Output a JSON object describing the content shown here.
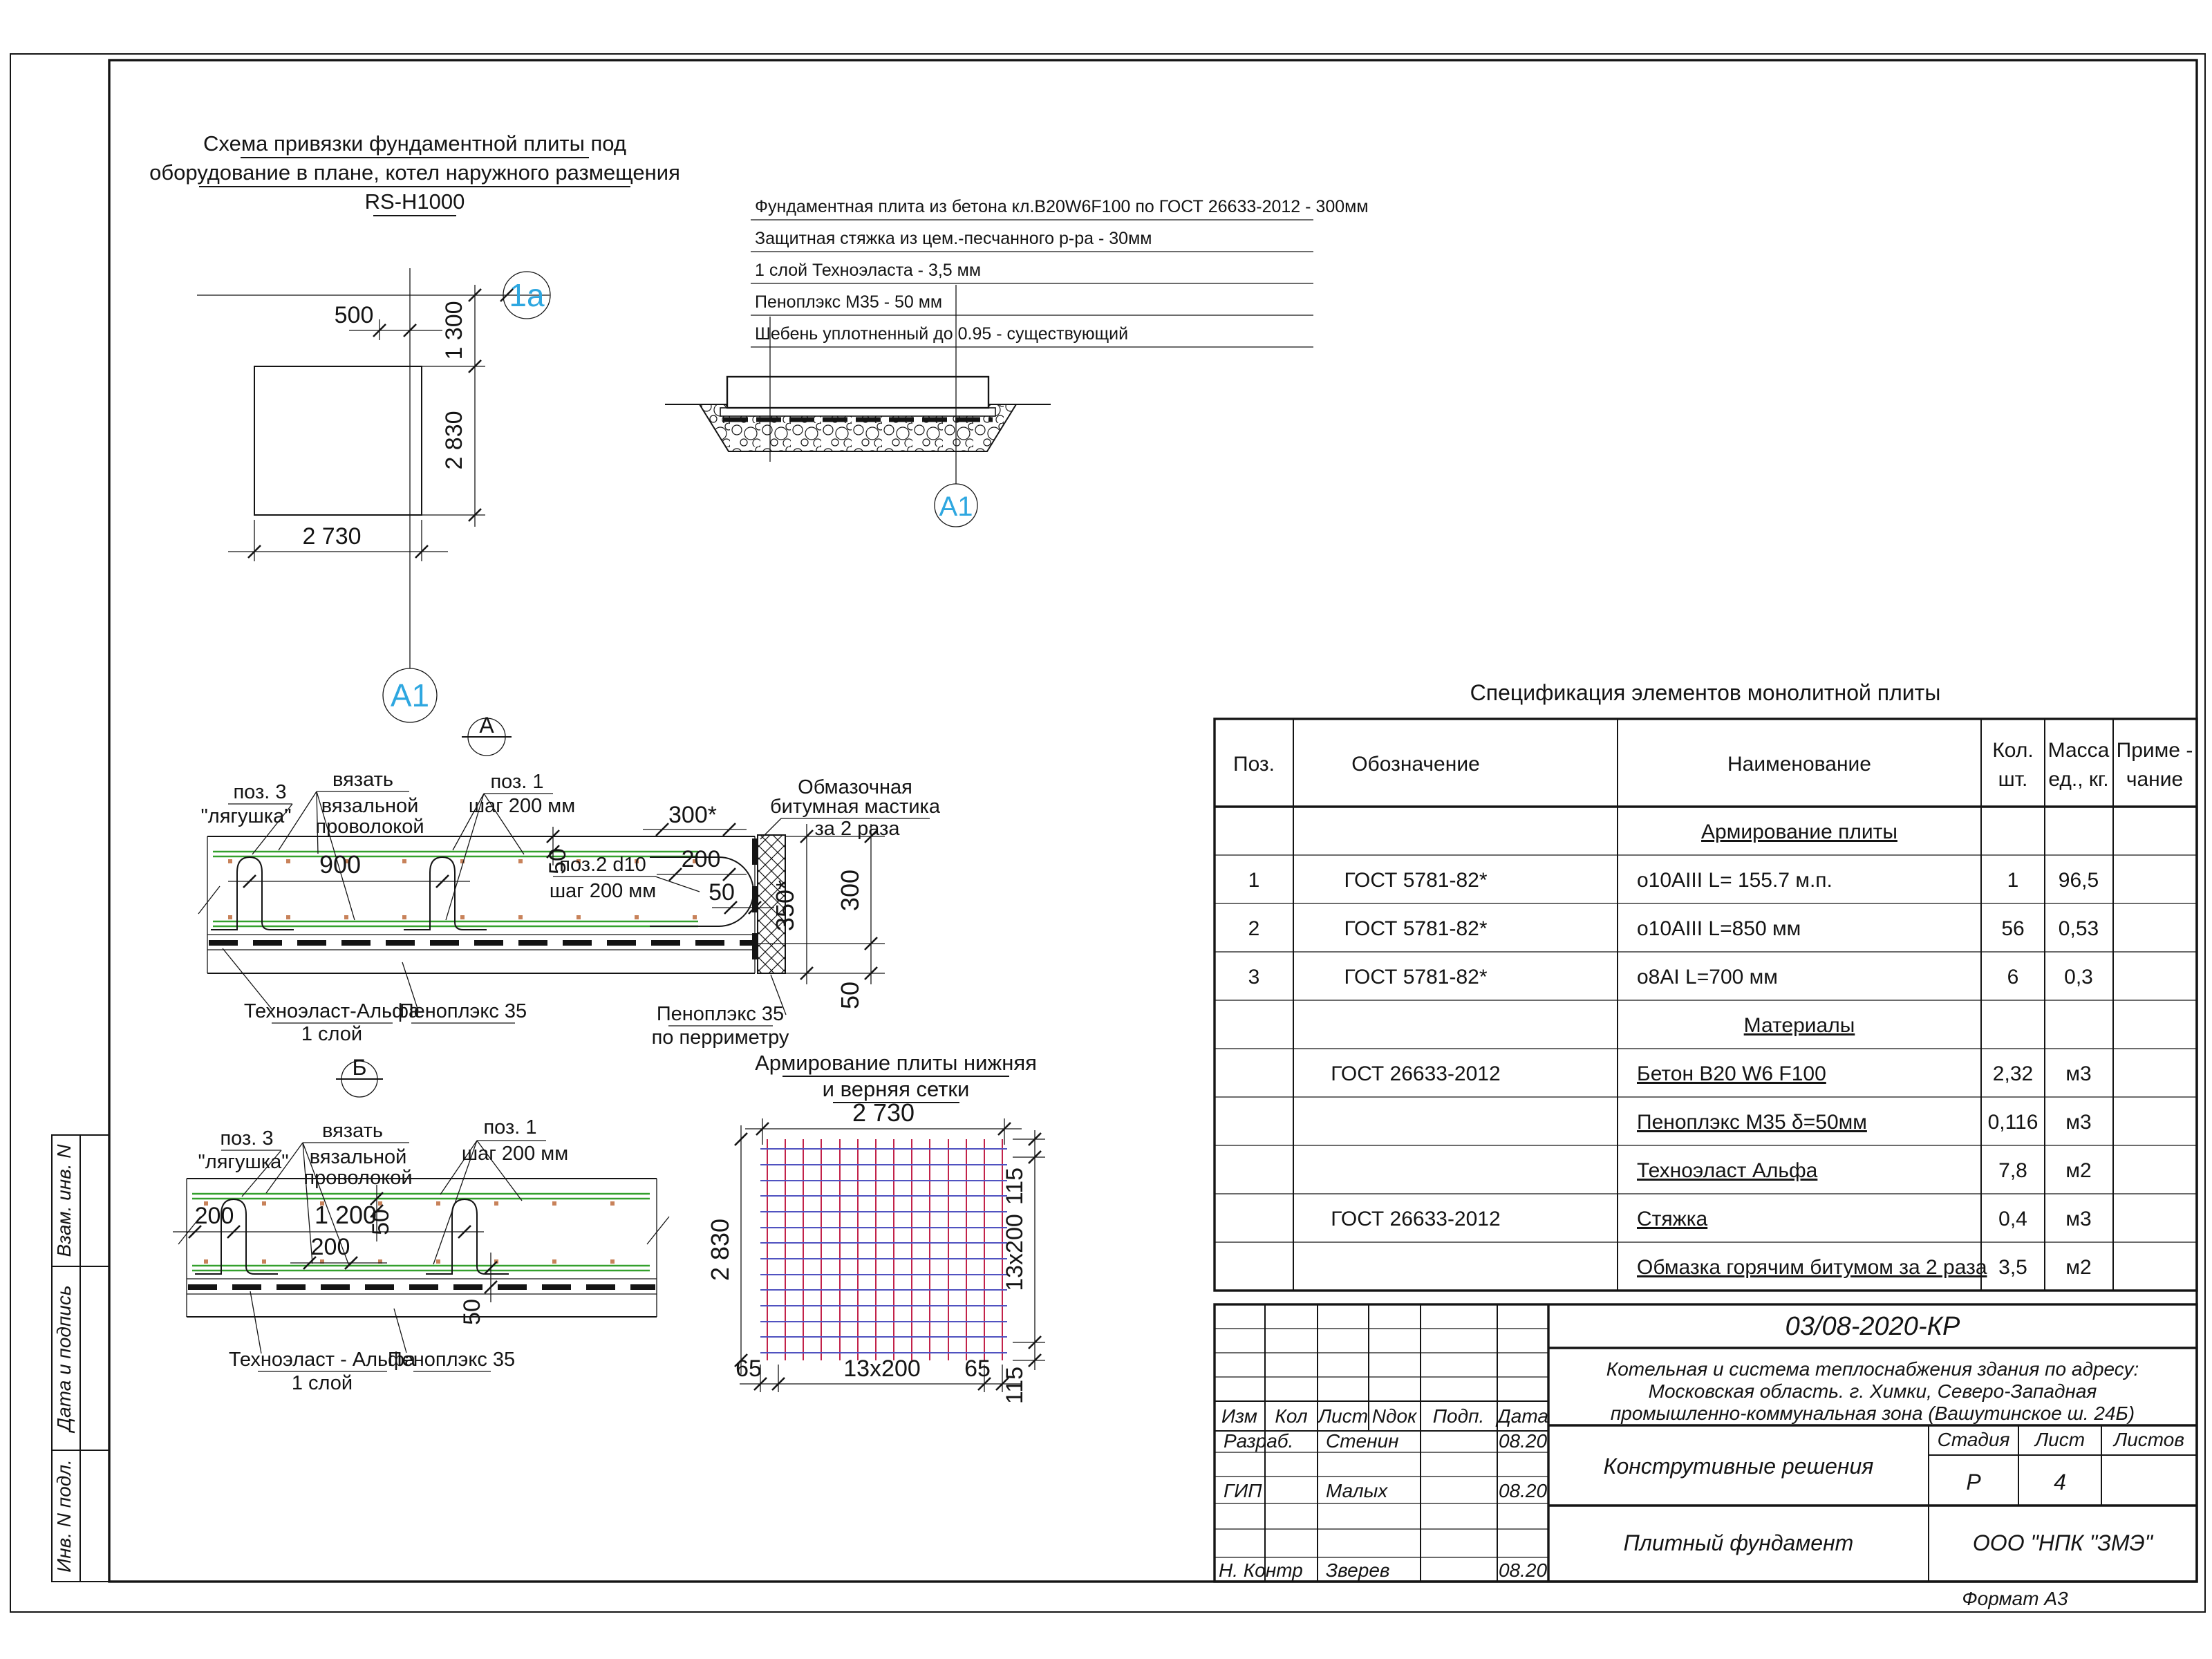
{
  "sheet": {
    "format_label": "Формат А3",
    "side_labels": [
      "Взам. инв. N",
      "Дата и подпись",
      "Инв. N подл."
    ]
  },
  "colors": {
    "axis_marker_blue": "#2ea7e0",
    "mesh_green": "#33a02c",
    "grid_red": "#c2224a",
    "grid_blue": "#5052c0",
    "dot_orange": "#c8825a"
  },
  "plan": {
    "title_line1": "Схема привязки фундаментной плиты под",
    "title_line2": "оборудование в плане, котел наружного размещения",
    "title_line3": "RS-H1000",
    "axis_top": "1a",
    "axis_bottom": "A1",
    "section_mark": "А",
    "dim_top": "500",
    "dim_right_upper": "1 300",
    "dim_right_lower": "2 830",
    "dim_bottom": "2 730"
  },
  "cross_section": {
    "layers": [
      "Фундаментная плита из бетона кл.B20W6F100 по ГОСТ 26633-2012 - 300мм",
      "Защитная стяжка из цем.-песчанного р-ра - 30мм",
      "1 слой Техноэласта - 3,5 мм",
      "Пеноплэкс М35 - 50 мм",
      "Шебень уплотненный до 0.95 - существующий"
    ],
    "axis_mark": "A1"
  },
  "section_a": {
    "mark": "А",
    "pos3_line1": "поз. 3",
    "pos3_line2": "\"лягушка\"",
    "tie_line1": "вязать",
    "tie_line2": "вязальной",
    "tie_line3": "проволокой",
    "pos1_line1": "поз. 1",
    "pos1_line2": "шаг 200 мм",
    "pos2_line1": "поз.2 d10",
    "pos2_line2": "шаг 200 мм",
    "mastic_line1": "Обмазочная",
    "mastic_line2": "битумная мастика",
    "mastic_line3": "за 2 раза",
    "dim_900": "900",
    "dim_300s": "300*",
    "dim_200": "200",
    "dim_50_edge": "50",
    "dim_50_cover": "50",
    "dim_350s": "350*",
    "dim_300": "300",
    "dim_50_bottom": "50",
    "tehnoelast_line1": "Техноэласт-Альфа",
    "tehnoelast_line2": "1 слой",
    "penoplex": "Пеноплэкс 35",
    "penoplex_perim_line1": "Пеноплэкс 35",
    "penoplex_perim_line2": "по перриметру"
  },
  "section_b": {
    "mark": "Б",
    "pos3_line1": "поз. 3",
    "pos3_line2": "\"лягушка\"",
    "tie_line1": "вязать",
    "tie_line2": "вязальной",
    "tie_line3": "проволокой",
    "pos1_line1": "поз. 1",
    "pos1_line2": "шаг 200 мм",
    "dim_200_left": "200",
    "dim_1200": "1 200",
    "dim_50_top": "50",
    "dim_200_mid": "200",
    "dim_50_right": "50",
    "tehnoelast_line1": "Техноэласт - Альфа",
    "tehnoelast_line2": "1 слой",
    "penoplex": "Пеноплэкс 35"
  },
  "grid_view": {
    "title_line1": "Армирование плиты нижняя",
    "title_line2": "и верняя сетки",
    "dim_top": "2 730",
    "dim_left": "2 830",
    "dim_right_top": "115",
    "dim_right_mid": "13x200",
    "dim_right_bottom": "115",
    "dim_bottom_left": "65",
    "dim_bottom_mid": "13x200",
    "dim_bottom_right": "65"
  },
  "spec_table": {
    "title": "Спецификация элементов монолитной плиты",
    "col_pos": "Поз.",
    "col_designation": "Обозначение",
    "col_name": "Наименование",
    "col_qty_1": "Кол.",
    "col_qty_2": "шт.",
    "col_mass_1": "Масса",
    "col_mass_2": "ед., кг.",
    "col_note_1": "Приме -",
    "col_note_2": "чание",
    "rows": [
      {
        "pos": "",
        "designation": "",
        "name": "Армирование плиты",
        "qty": "",
        "mass": ""
      },
      {
        "pos": "1",
        "designation": "ГОСТ 5781-82*",
        "name": "o10AIII L= 155.7 м.п.",
        "qty": "1",
        "mass": "96,5"
      },
      {
        "pos": "2",
        "designation": "ГОСТ 5781-82*",
        "name": "o10AIII L=850 мм",
        "qty": "56",
        "mass": "0,53"
      },
      {
        "pos": "3",
        "designation": "ГОСТ 5781-82*",
        "name": "o8AI L=700 мм",
        "qty": "6",
        "mass": "0,3"
      },
      {
        "pos": "",
        "designation": "",
        "name": "Материалы",
        "qty": "",
        "mass": ""
      },
      {
        "pos": "",
        "designation": "ГОСТ 26633-2012",
        "name": "Бетон B20 W6 F100",
        "qty": "2,32",
        "mass": "м3"
      },
      {
        "pos": "",
        "designation": "",
        "name": "Пеноплэкс М35 δ=50мм",
        "qty": "0,116",
        "mass": "м3"
      },
      {
        "pos": "",
        "designation": "",
        "name": "Техноэласт Альфа",
        "qty": "7,8",
        "mass": "м2"
      },
      {
        "pos": "",
        "designation": "ГОСТ 26633-2012",
        "name": "Стяжка",
        "qty": "0,4",
        "mass": "м3"
      },
      {
        "pos": "",
        "designation": "",
        "name": "Обмазка горячим битумом за 2 раза",
        "qty": "3,5",
        "mass": "м2"
      }
    ]
  },
  "title_block": {
    "doc_number": "03/08-2020-КР",
    "project_line1": "Котельная и система теплоснабжения здания по адресу:",
    "project_line2": "Московская область. г. Химки, Северо-Западная",
    "project_line3": "промышленно-коммунальная зона (Вашутинское ш. 24Б)",
    "doc_type": "Конструтивные решения",
    "sheet_name": "Плитный фундамент",
    "company": "ООО \"НПК \"ЗМЭ\"",
    "col_izm": "Изм",
    "col_kol": "Кол",
    "col_list": "Лист",
    "col_ndok": "Nдок",
    "col_podp": "Подп.",
    "col_data": "Дата",
    "row_razrab_role": "Разраб.",
    "row_razrab_name": "Стенин",
    "row_razrab_date": "08.20",
    "row_gip_role": "ГИП",
    "row_gip_name": "Малых",
    "row_gip_date": "08.20",
    "row_nkontr_role": "Н. Контр",
    "row_nkontr_name": "Зверев",
    "row_nkontr_date": "08.20",
    "stage_label": "Стадия",
    "list_label": "Лист",
    "listov_label": "Листов",
    "stage_value": "Р",
    "list_value": "4",
    "listov_value": ""
  }
}
